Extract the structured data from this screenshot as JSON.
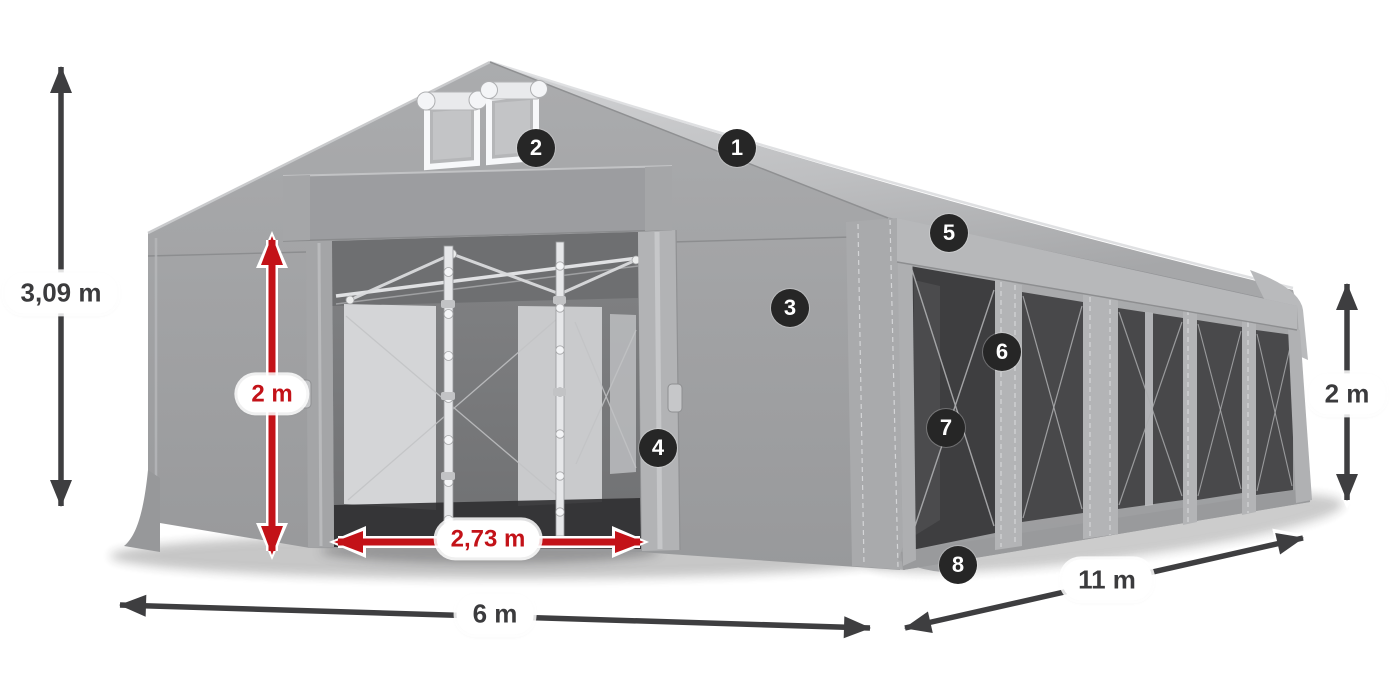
{
  "diagram": {
    "subject": "tent-dimensions-diagram",
    "dimensions": {
      "total_height": "3,09 m",
      "entrance_height": "2 m",
      "entrance_width": "2,73 m",
      "front_width": "6 m",
      "side_length": "11 m",
      "side_height": "2 m"
    },
    "badges": [
      {
        "label": "1"
      },
      {
        "label": "2"
      },
      {
        "label": "3"
      },
      {
        "label": "4"
      },
      {
        "label": "5"
      },
      {
        "label": "6"
      },
      {
        "label": "7"
      },
      {
        "label": "8"
      }
    ],
    "colors": {
      "background": "#ffffff",
      "red_accent": "#c31218",
      "dark_arrow": "#3e3e40",
      "label_background": "#ffffff",
      "label_text": "#3b3b3d",
      "badge_background": "#262626",
      "badge_text": "#ffffff",
      "fabric_light": "#cfd0d2",
      "fabric_mid": "#a7a8aa",
      "fabric_shadow": "#98999b",
      "window_tint": "#48484a"
    }
  }
}
